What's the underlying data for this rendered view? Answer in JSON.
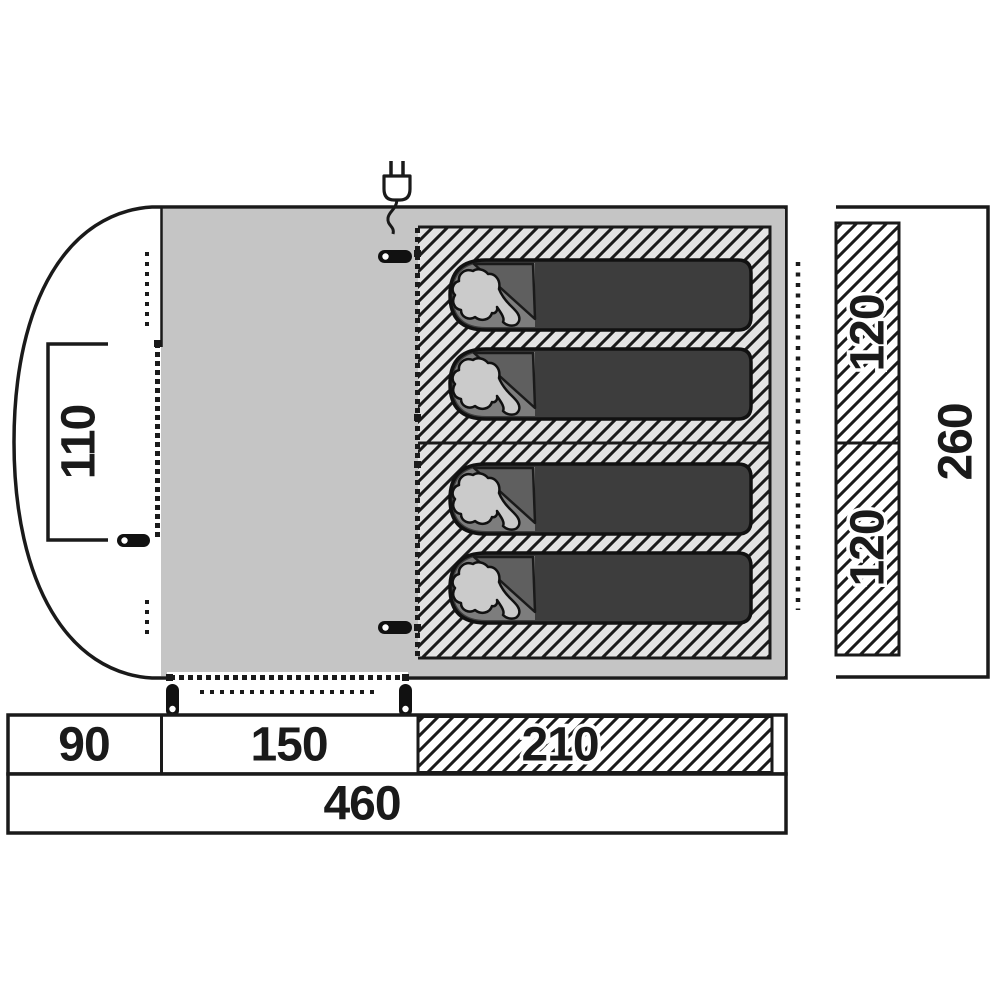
{
  "title": "Tent floor plan with dimensions (cm)",
  "dimensions": {
    "window_width": "110",
    "bedroom_width_top": "120",
    "bedroom_width_bottom": "120",
    "tent_depth": "260",
    "porch_length": "90",
    "living_length": "150",
    "bedroom_length": "210",
    "total_length": "460"
  },
  "icons": {
    "power_plug": "plug-icon"
  },
  "features": {
    "sleeping_bag_count": 4,
    "bedroom_sections": 2
  },
  "colors": {
    "outline": "#1a1a1a",
    "living_area": "#c5c5c5",
    "bedroom_hatch_bg": "#e3e3e3",
    "dimension_hatch_bg": "#ffffff",
    "sleeping_bag": "#3d3d3d",
    "sleeping_bag_flap": "#5f5f5f",
    "sleeping_bag_hood": "#7d7d7d",
    "pillow": "#cbcbcb"
  }
}
